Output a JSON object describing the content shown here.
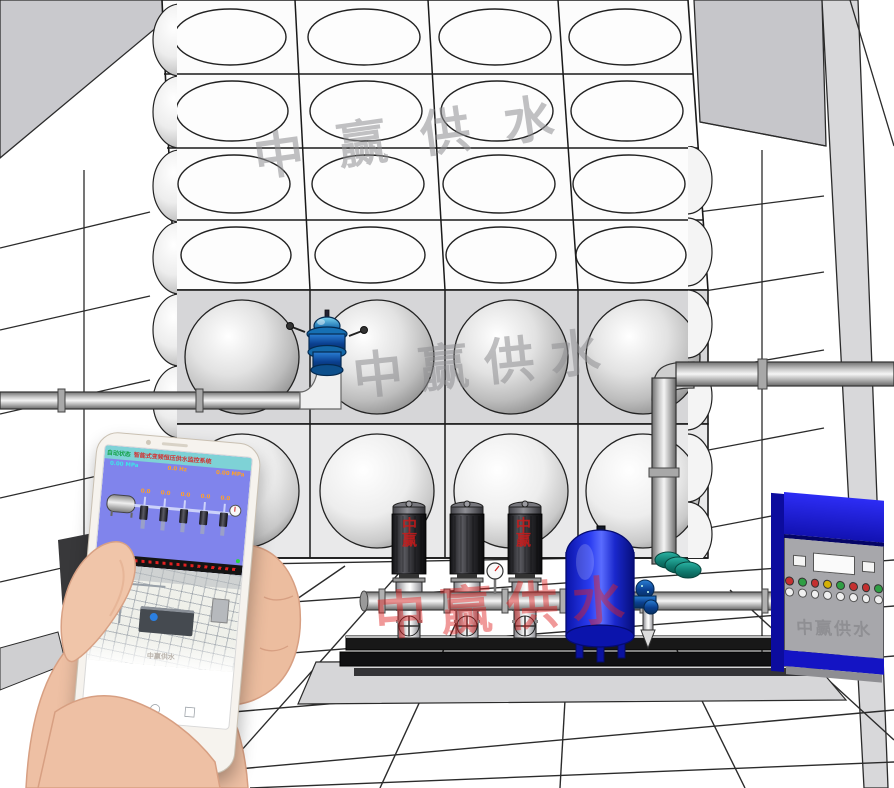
{
  "scene": {
    "description": "3D rendering of a variable-frequency constant-pressure water supply system: stainless steel modular water tank, three vertical multistage pumps on a skid, blue diaphragm pressure tank, float valve, piping, control cabinet, in a white tiled pump room; a hand holds a smartphone running the remote monitoring app.",
    "room": {
      "wall_color": "#ffffff",
      "line_color": "#2b2b2b",
      "ceiling_color": "#c9c9cd",
      "pillar_color": "#d8d8da",
      "pad_color": "#d6d6d8"
    }
  },
  "watermarks": {
    "brand": "中赢供水",
    "motor_mark": "中赢",
    "gray_color": "#8f8f92",
    "red_color": "#e02020"
  },
  "tank": {
    "top_rows": 4,
    "columns": 4,
    "front_rows": 2,
    "line_color": "#1a1a1a"
  },
  "equipment": {
    "pump_count": 3,
    "pressure_tank_color": "#1f2cd6",
    "float_valve_color": "#1a6fb0",
    "check_valve_color": "#1f8f80",
    "base_color": "#17171a"
  },
  "cabinet": {
    "watermark": "中赢供水",
    "top_color": "#1d1de0",
    "face_color": "#a7a7ab",
    "base_color": "#1414c4",
    "lights": [
      "#c43030",
      "#2f9e44",
      "#c43030",
      "#d4b106",
      "#2f9e44",
      "#c43030",
      "#c43030",
      "#2f9e44"
    ],
    "knobs": [
      "",
      "",
      "",
      "",
      "",
      "",
      "",
      ""
    ]
  },
  "phone": {
    "body_color": "#f6f3ee",
    "scada": {
      "status": "自动状态",
      "title": "智能式变频恒压供水监控系统",
      "left_readout": "0.00 MPa",
      "mid_readout": "0.0 Hz",
      "right_readout": "0.00 MPa",
      "pump_values": [
        "0.0",
        "0.0",
        "0.0",
        "0.0",
        "0.0"
      ],
      "bg_color": "#8084ec",
      "titlebar_color": "#7ed2d6",
      "status_color": "#17a34a",
      "title_color": "#d43030",
      "value_color": "#ffa028",
      "label_color": "#3ae8e8",
      "marquee_color": "#e22020",
      "run_dot_color": "#28d43c"
    },
    "room_view_watermark": "中赢供水",
    "nav_icons": [
      {
        "name": "back",
        "glyph": "◁"
      },
      {
        "name": "home",
        "glyph": "○"
      },
      {
        "name": "recents",
        "glyph": "□"
      }
    ]
  }
}
